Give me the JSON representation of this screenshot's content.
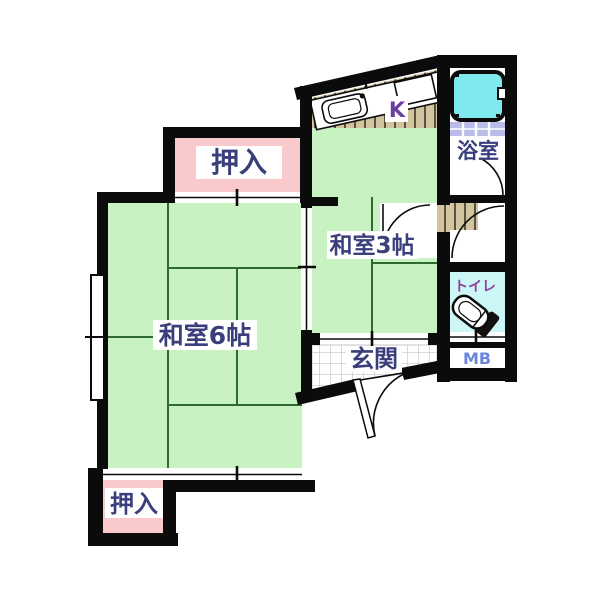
{
  "plan_title": "apartment-floor-plan",
  "labels": {
    "closet_top": "押入",
    "closet_bottom": "押入",
    "washitsu_6": "和室6帖",
    "washitsu_3": "和室3帖",
    "entrance": "玄関",
    "bathroom": "浴室",
    "toilet": "トイレ",
    "kitchen": "K",
    "meter_box": "MB"
  },
  "colors": {
    "wall": "#0b0b0b",
    "tatami_green": "#c9f2c2",
    "closet_pink": "#f9c9cb",
    "bathtub_cyan": "#80e9ef",
    "toilet_floor_cyan": "#cdf6f6",
    "bath_tile_lavender": "#b9bce8",
    "kitchen_floor_tan": "#d2c49e",
    "label_navy": "#3a3f7c",
    "toilet_label_purple": "#8a3f9e",
    "kitchen_label_purple": "#6b3fa0",
    "meter_box_blue": "#6b86e0"
  }
}
